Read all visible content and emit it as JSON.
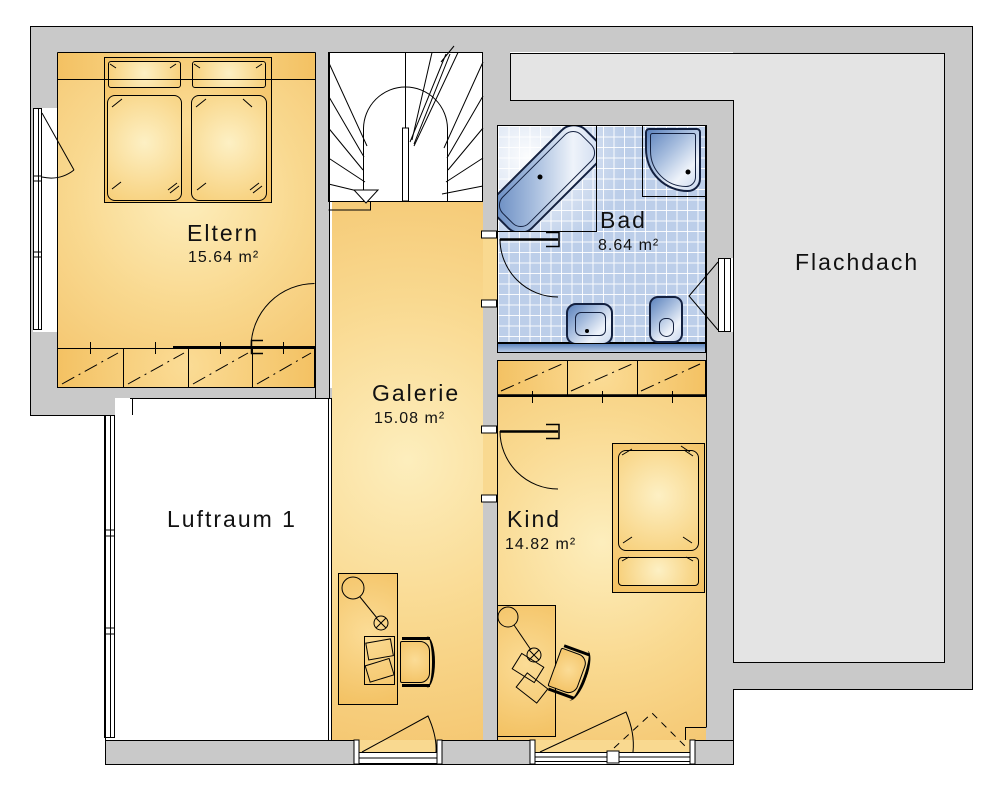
{
  "rooms": {
    "eltern": {
      "name": "Eltern",
      "area": "15.64 m²"
    },
    "bad": {
      "name": "Bad",
      "area": "8.64 m²"
    },
    "galerie": {
      "name": "Galerie",
      "area": "15.08 m²"
    },
    "kind": {
      "name": "Kind",
      "area": "14.82 m²"
    },
    "luftraum": {
      "name": "Luftraum 1"
    },
    "flachdach": {
      "name": "Flachdach"
    }
  },
  "icons": {
    "stairs": "winder-staircase-icon",
    "stair_direction": "down-arrow-icon",
    "bathtub": "corner-bathtub-icon",
    "shower": "corner-shower-icon",
    "sink": "washbasin-icon",
    "toilet": "toilet-icon",
    "beds": "double-bed-icon",
    "desk_lamp": "desk-lamp-icon"
  },
  "colors": {
    "wall": "#c9c9c9",
    "roof": "#e4e4e4",
    "line": "#000000",
    "floor-light": "#fdeebd",
    "floor-mid": "#f9d990",
    "floor-dark": "#f5c873",
    "furniture": "#f3c162",
    "furniture-light": "#fbdc96",
    "tile": "#bccee9",
    "fixture-dark": "#5d83bd",
    "fixture-light": "#eef3fa",
    "fixture-border": "#13203f",
    "text": "#111111"
  }
}
